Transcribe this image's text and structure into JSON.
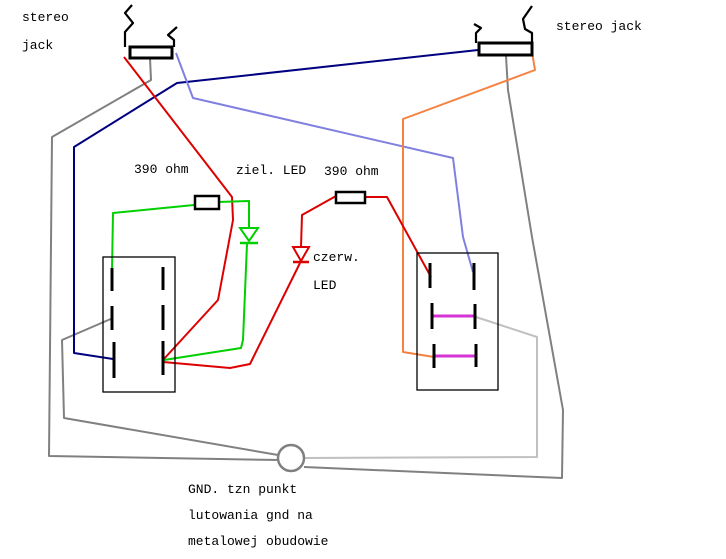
{
  "labels": {
    "left_jack_l1": "stereo",
    "left_jack_l2": "jack",
    "right_jack": "stereo jack",
    "resistor_left": "390 ohm",
    "led_green": "ziel. LED",
    "resistor_right": "390 ohm",
    "led_red_l1": "czerw.",
    "led_red_l2": "LED",
    "gnd_l1": "GND. tzn punkt",
    "gnd_l2": "lutowania gnd na",
    "gnd_l3": "metalowej obudowie"
  },
  "colors": {
    "black": "#000000",
    "red": "#dd0000",
    "green": "#00d000",
    "navy": "#000080",
    "periwinkle": "#8080e0",
    "orange": "#f58240",
    "gray": "#808080",
    "silver": "#c0c0c0",
    "magenta": "#d633d6",
    "background": "#ffffff"
  }
}
